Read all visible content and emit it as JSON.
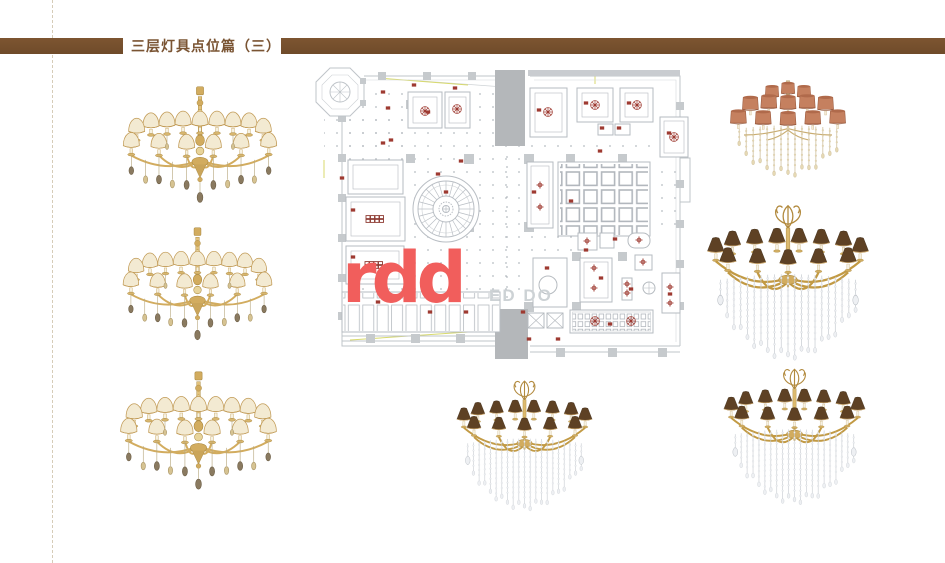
{
  "header": {
    "title": "三层灯具点位篇（三）"
  },
  "watermark": {
    "logo": "rdd",
    "partial_text": "ED DO"
  },
  "palette": {
    "header_bar_brown": "#7d5531",
    "header_bar_brown2": "#6f4b2a",
    "title_brown": "#7a5433",
    "guide_tan": "#d6ccb8",
    "logo_coral": "#f15e5c",
    "watermark_gray": "#cdd2d5",
    "plan_line_gray": "#b9bec4",
    "plan_wall_gray": "#c9ccd0",
    "plan_shaft_gray": "#b4b7ba",
    "fixture_marker_red": "#9e3a31",
    "accent_yellow": "#d8da6d",
    "gold": "#c9a14e",
    "cream_shade": "#f3ead2",
    "salmon_shade": "#c5805f",
    "brown_shade": "#5e4124",
    "crystal_white": "#eef0f3",
    "champagne": "#d9c79e"
  },
  "chandeliers": [
    {
      "id": "left-top",
      "style": "gold-crystal-chandelier-cream-shades"
    },
    {
      "id": "left-middle",
      "style": "gold-crystal-chandelier-cream-shades"
    },
    {
      "id": "left-bottom",
      "style": "gold-crystal-chandelier-cream-shades"
    },
    {
      "id": "right-top",
      "style": "crystal-chandelier-salmon-drum-shades"
    },
    {
      "id": "right-middle",
      "style": "gold-crystal-chandelier-brown-cone-shades"
    },
    {
      "id": "right-bottom",
      "style": "gold-crystal-chandelier-brown-cone-shades"
    },
    {
      "id": "bottom-center",
      "style": "gold-crystal-chandelier-brown-cone-shades"
    }
  ]
}
